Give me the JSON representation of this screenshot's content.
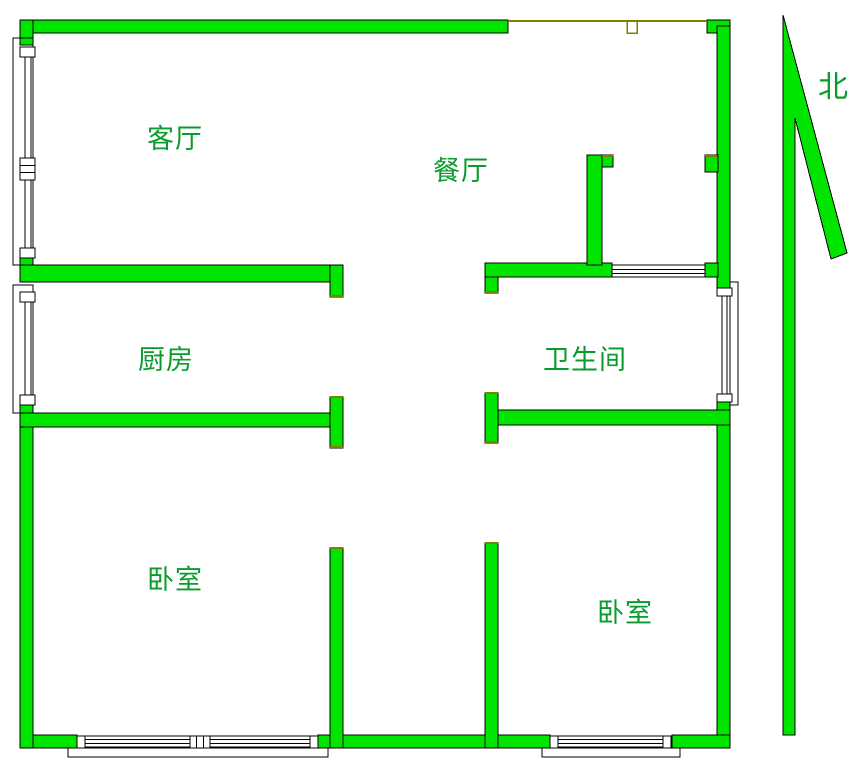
{
  "figure": {
    "type": "apartment-floor-plan"
  },
  "labels": {
    "living_room": "客厅",
    "dining_room": "餐厅",
    "kitchen": "厨房",
    "bathroom": "卫生间",
    "bedroom_left": "卧室",
    "bedroom_right": "卧室",
    "north": "北"
  },
  "colors": {
    "wall_fill": "#00e400",
    "wall_outline": "#000000",
    "opening_line": "#808000",
    "label_text": "#0a9b2d",
    "background": "#ffffff"
  }
}
